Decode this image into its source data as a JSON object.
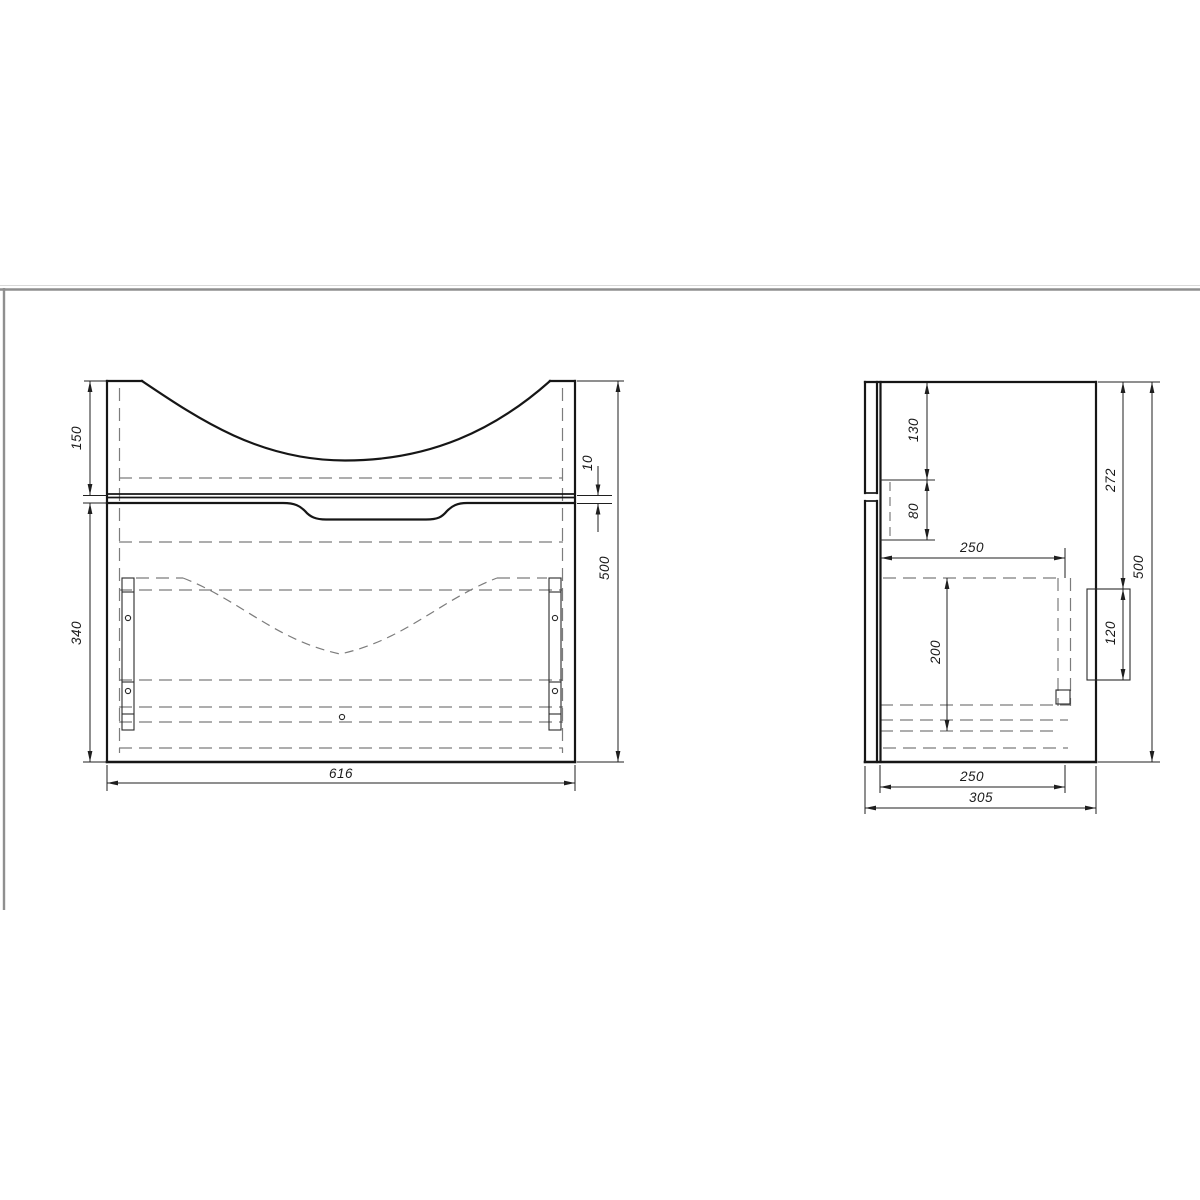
{
  "drawing": {
    "type": "furniture technical drawing, bathroom vanity cabinet, two orthographic views",
    "colors": {
      "line": "#161616",
      "hidden_line": "#7c7c7c",
      "dimension": "#1f1f1f",
      "sheet_border": "#8f8f8f",
      "background": "#ffffff"
    }
  },
  "front_dims": {
    "top_section_height": "150",
    "drawer_section_height": "340",
    "width": "616",
    "gap": "10",
    "total_height": "500"
  },
  "side_dims": {
    "top_offset": "130",
    "siphon_height": "80",
    "drawer_depth_top": "250",
    "drawer_height": "200",
    "bracket_offset": "272",
    "bracket_height": "120",
    "total_height": "500",
    "drawer_depth_bottom": "250",
    "total_depth": "305"
  }
}
